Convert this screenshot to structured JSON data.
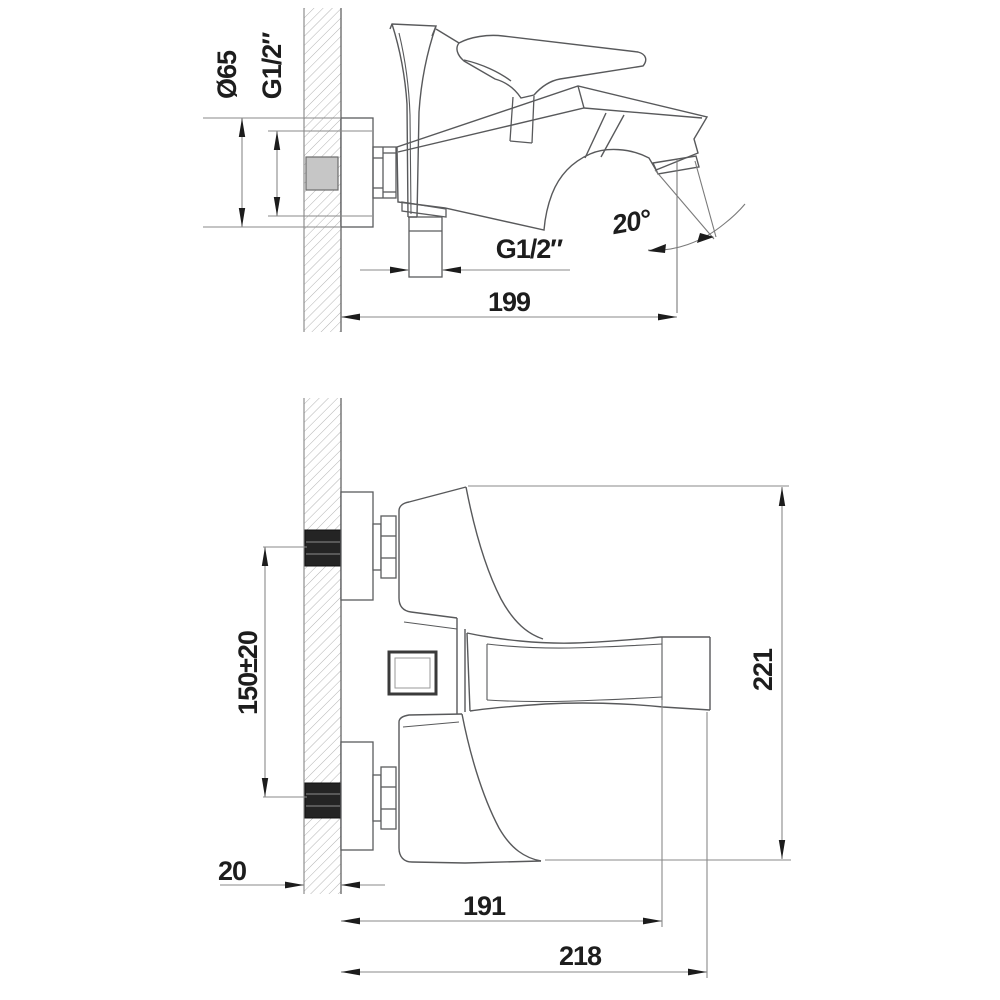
{
  "drawing": {
    "description": "Wall-mounted bath mixer installation drawing, two orthographic views with dimensions",
    "units_implied": "mm",
    "top_view": {
      "flange_diameter_label": "Ø65",
      "wall_connection_thread_label": "G1/2″",
      "shower_outlet_thread_label": "G1/2″",
      "spout_angle_label": "20°",
      "length_from_wall_label": "199"
    },
    "bottom_view": {
      "connection_centers_label": "150±20",
      "overall_height_label": "221",
      "wall_thickness_label": "20",
      "spout_reach_label": "191",
      "overall_reach_label": "218"
    }
  }
}
